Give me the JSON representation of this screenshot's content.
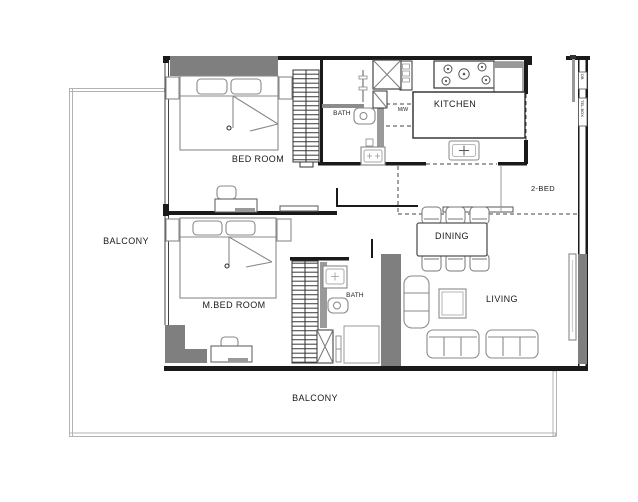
{
  "floor_plan": {
    "unit_type": "2-BED",
    "labels": {
      "bedroom": "BED ROOM",
      "master_bedroom": "M.BED ROOM",
      "bath_top": "BATH",
      "bath_master": "BATH",
      "kitchen": "KITCHEN",
      "microwave": "M/W",
      "dining": "DINING",
      "living": "LIVING",
      "balcony_left": "BALCONY",
      "balcony_bottom": "BALCONY",
      "db_panel": "DB",
      "tel_box": "TEL.BOX"
    },
    "colors": {
      "background": "#ffffff",
      "wall_line": "#1a1a1a",
      "wall_fill": "#7f7f7f",
      "furniture_line": "#8a8a8a",
      "vanity_fill": "#9a9a9a",
      "balcony_rail": "#b3b3b3",
      "text": "#1a1a1a"
    }
  }
}
